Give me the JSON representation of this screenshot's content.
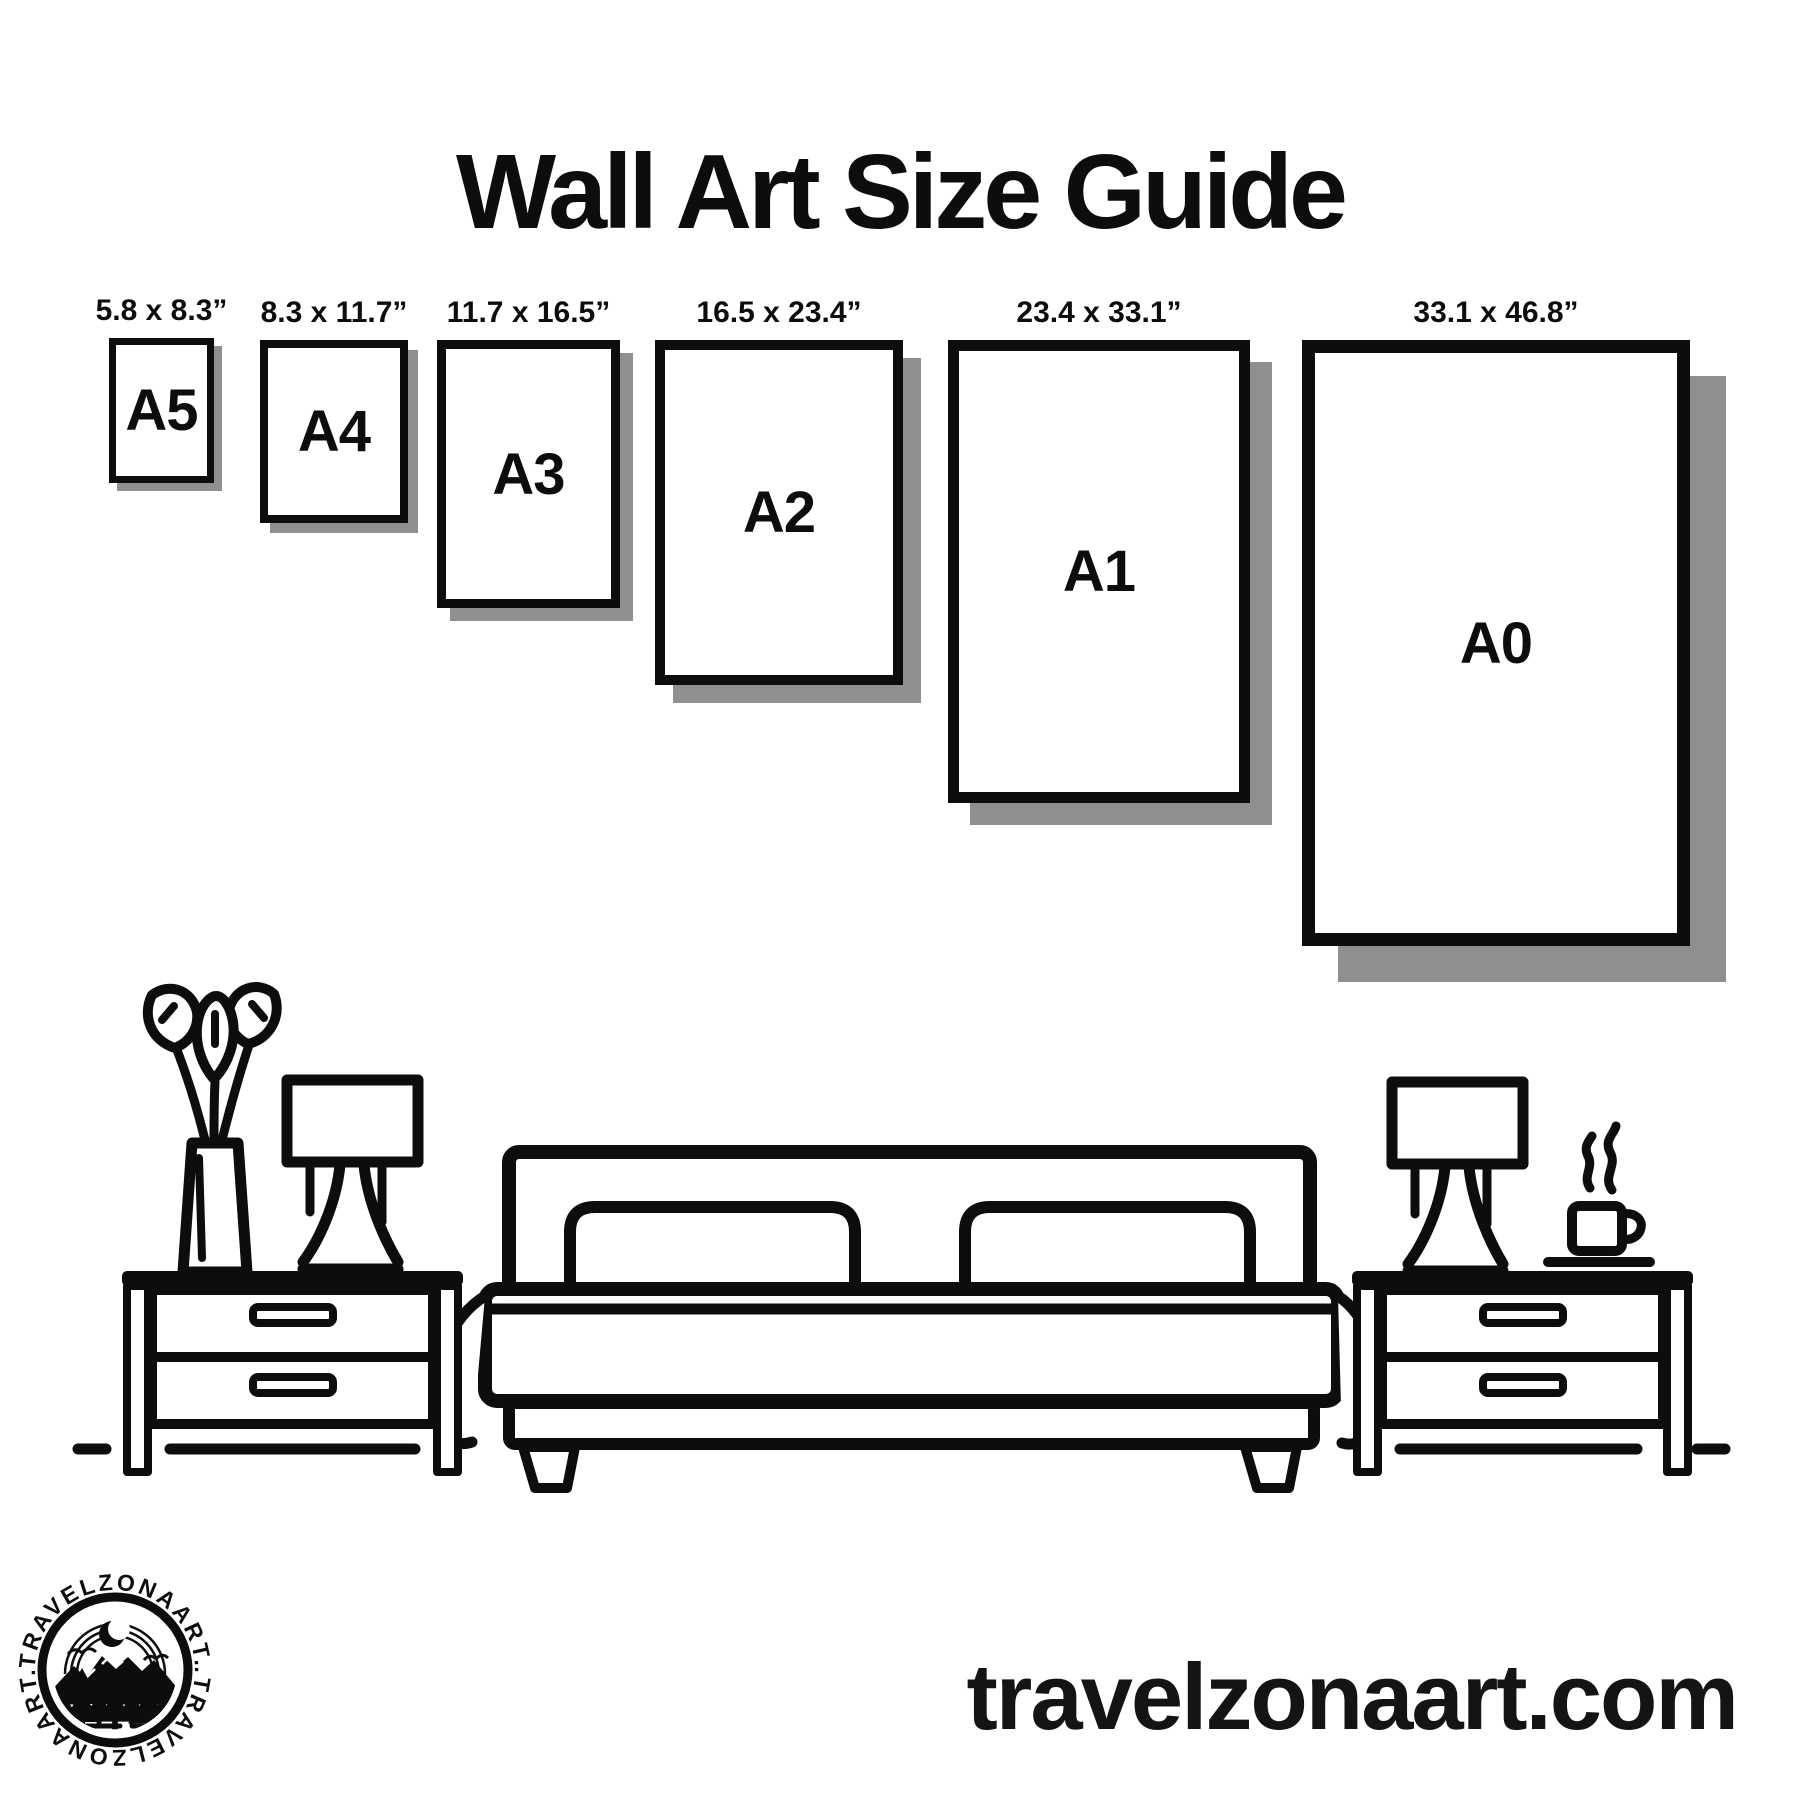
{
  "title": "Wall Art Size Guide",
  "frames": [
    {
      "id": "a5",
      "letter": "A5",
      "size_label": "5.8 x 8.3”",
      "box": {
        "x": 109,
        "y": 338,
        "w": 105,
        "h": 145,
        "border": 7,
        "shadow": 8
      }
    },
    {
      "id": "a4",
      "letter": "A4",
      "size_label": "8.3 x 11.7”",
      "box": {
        "x": 260,
        "y": 340,
        "w": 148,
        "h": 183,
        "border": 8,
        "shadow": 10
      }
    },
    {
      "id": "a3",
      "letter": "A3",
      "size_label": "11.7 x 16.5”",
      "box": {
        "x": 437,
        "y": 340,
        "w": 183,
        "h": 268,
        "border": 9,
        "shadow": 13
      }
    },
    {
      "id": "a2",
      "letter": "A2",
      "size_label": "16.5 x 23.4”",
      "box": {
        "x": 655,
        "y": 340,
        "w": 248,
        "h": 345,
        "border": 10,
        "shadow": 18
      }
    },
    {
      "id": "a1",
      "letter": "A1",
      "size_label": "23.4 x 33.1”",
      "box": {
        "x": 948,
        "y": 340,
        "w": 302,
        "h": 463,
        "border": 11,
        "shadow": 22
      }
    },
    {
      "id": "a0",
      "letter": "A0",
      "size_label": "33.1 x 46.8”",
      "box": {
        "x": 1302,
        "y": 340,
        "w": 388,
        "h": 606,
        "border": 13,
        "shadow": 36
      }
    }
  ],
  "colors": {
    "ink": "#0d0d0d",
    "shadow": "#8f8f8f",
    "background": "#ffffff"
  },
  "logo": {
    "ring_text_top": "TRAVELZONAART.",
    "ring_text_bottom": ".TRAVELZONAART."
  },
  "website": "travelzonaart.com"
}
